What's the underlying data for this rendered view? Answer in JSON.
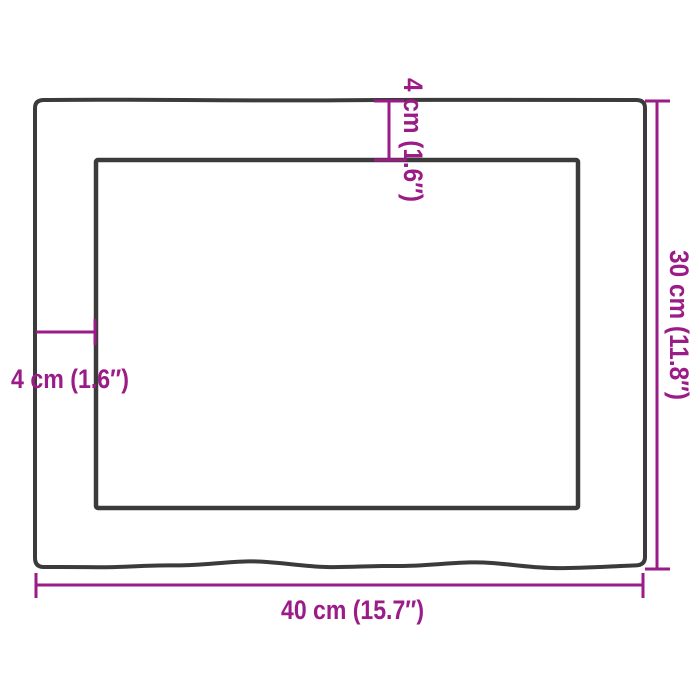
{
  "diagram": {
    "type": "product-dimension-drawing",
    "colors": {
      "outline": "#3b3b3b",
      "dimension": "#9b1b87",
      "background": "#ffffff"
    },
    "labels": {
      "width": "40 cm (15.7″)",
      "height": "30 cm (11.8″)",
      "top_inset": "4 cm (1.6″)",
      "left_inset": "4 cm (1.6″)"
    }
  }
}
